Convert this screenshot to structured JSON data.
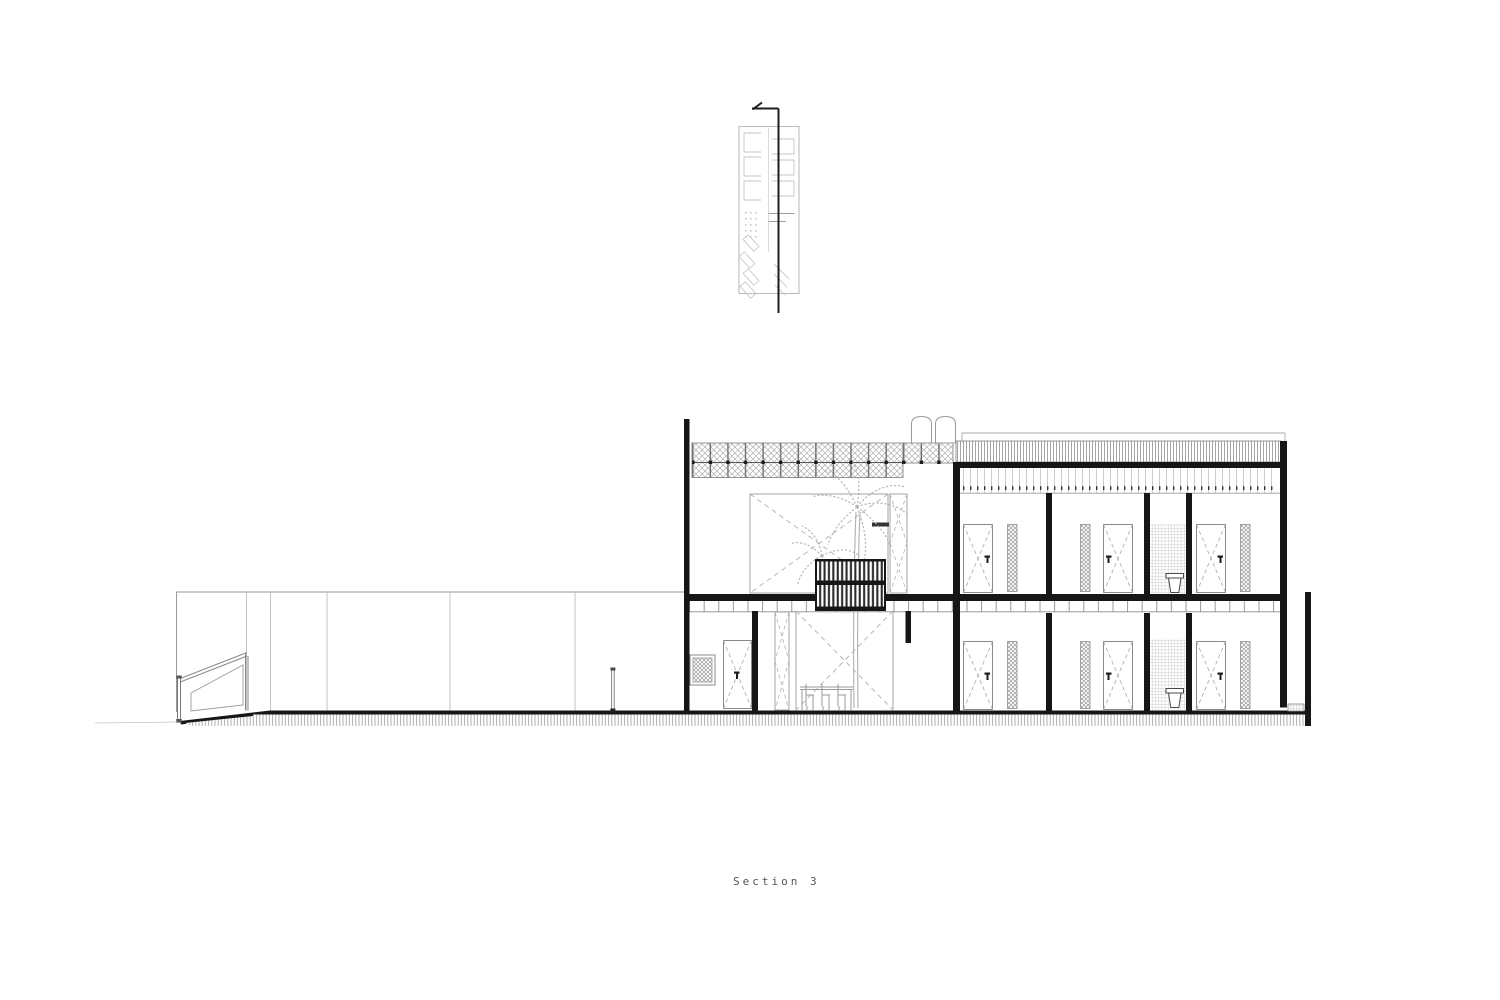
{
  "drawing": {
    "title": "Section 3",
    "type": "architectural building section with site key plan",
    "sheet_background": "#ffffff",
    "ink_color": "#1c1c1c",
    "line_color": "#8a8a8a",
    "light_line_color": "#bdbdbd",
    "title_color": "#555555",
    "floors": 2,
    "room_doors_per_floor": 3
  }
}
